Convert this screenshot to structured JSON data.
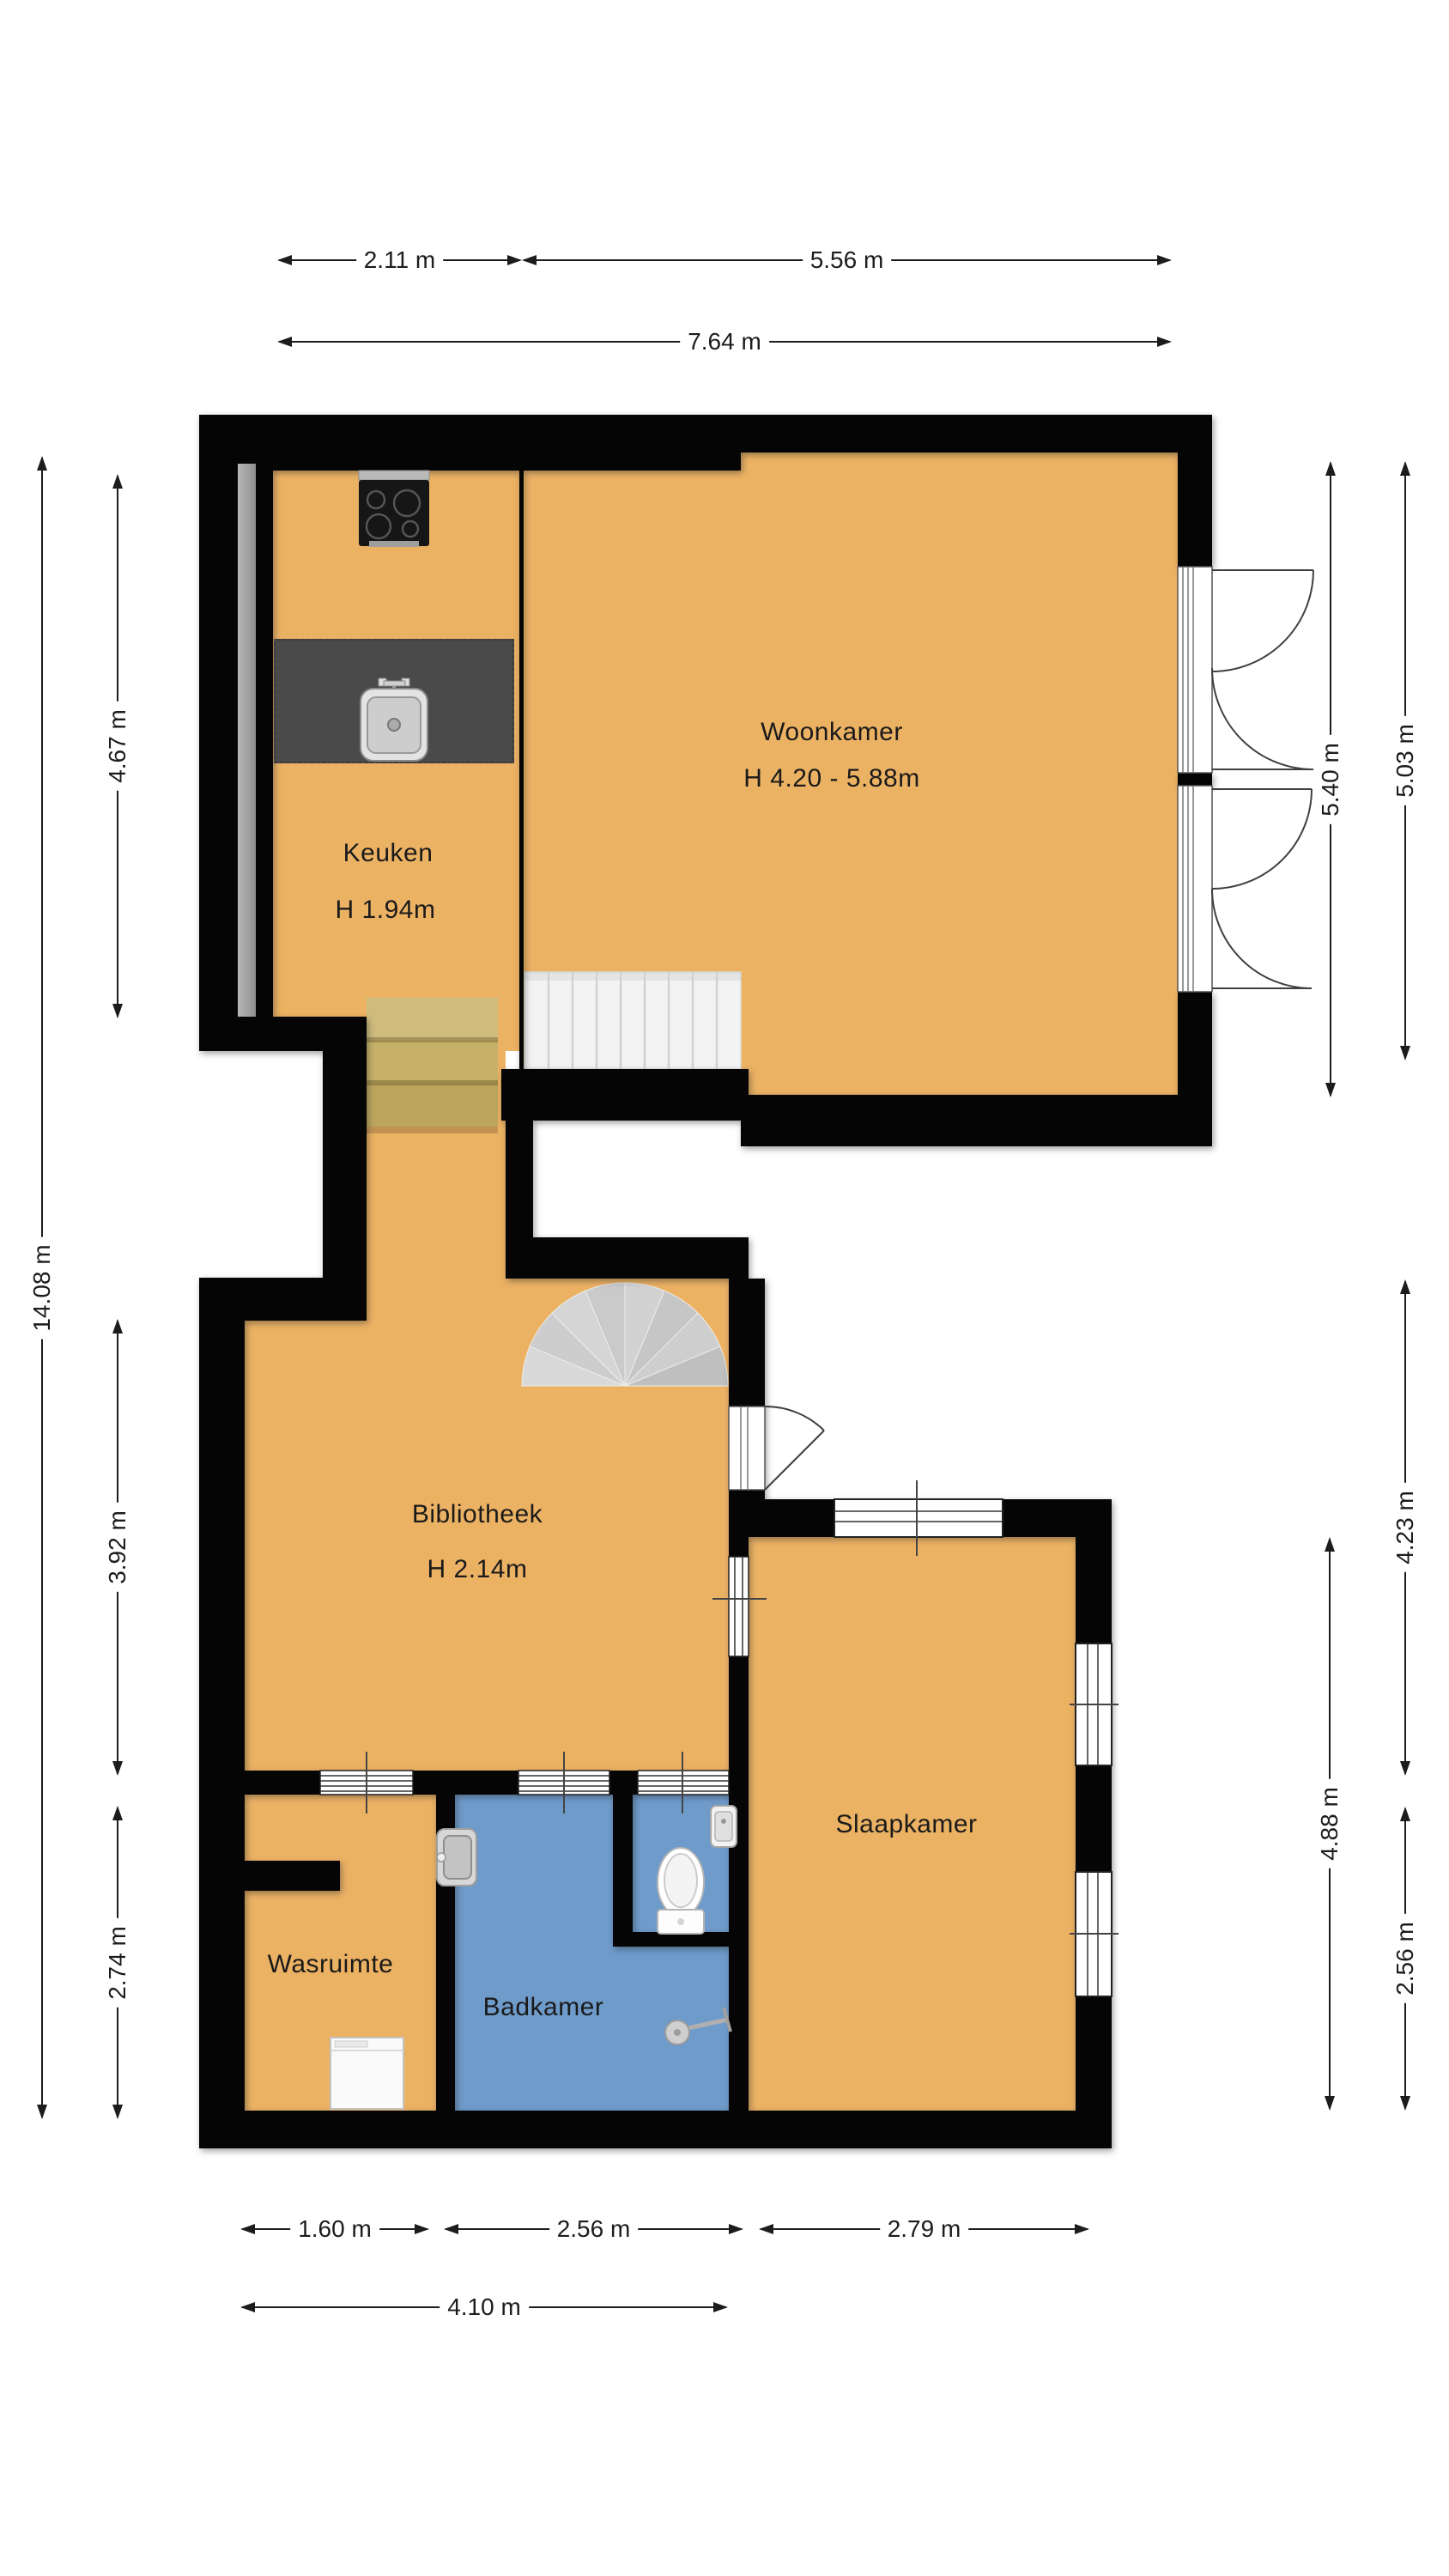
{
  "plan": {
    "rooms": {
      "woonkamer": {
        "label": "Woonkamer",
        "height": "H 4.20 - 5.88m"
      },
      "keuken": {
        "label": "Keuken",
        "height": "H 1.94m"
      },
      "bibliotheek": {
        "label": "Bibliotheek",
        "height": "H 2.14m"
      },
      "slaapkamer": {
        "label": "Slaapkamer"
      },
      "wasruimte": {
        "label": "Wasruimte"
      },
      "badkamer": {
        "label": "Badkamer"
      }
    },
    "dimensions": {
      "top": {
        "kitchen_width": "2.11 m",
        "living_width": "5.56 m",
        "total_width": "7.64 m"
      },
      "left": {
        "kitchen_height": "4.67 m",
        "total_height": "14.08 m",
        "library_height": "3.92 m",
        "laundry_height": "2.74 m"
      },
      "right": {
        "living_inner": "5.40 m",
        "living_glazing": "5.03 m",
        "upper_section": "4.23 m",
        "bedroom_height": "4.88 m",
        "lower_section": "2.56 m"
      },
      "bottom": {
        "laundry_width": "1.60 m",
        "bathroom_width": "2.56 m",
        "bedroom_width": "2.79 m",
        "lower_total": "4.10 m"
      }
    },
    "fixtures": [
      "stove",
      "kitchen-sink",
      "counter",
      "straight-stairs",
      "wood-steps",
      "spiral-stairs",
      "toilet",
      "hand-basin",
      "bathroom-sink",
      "shower",
      "washing-machine"
    ]
  },
  "colors": {
    "floor": "#ecb264",
    "bathroom_floor": "#6f9bcb",
    "wall": "#050505",
    "wood": "#c9b472",
    "stair": "#d2d2d2",
    "counter": "#4a4a4a",
    "dim": "#1c1c1c"
  }
}
